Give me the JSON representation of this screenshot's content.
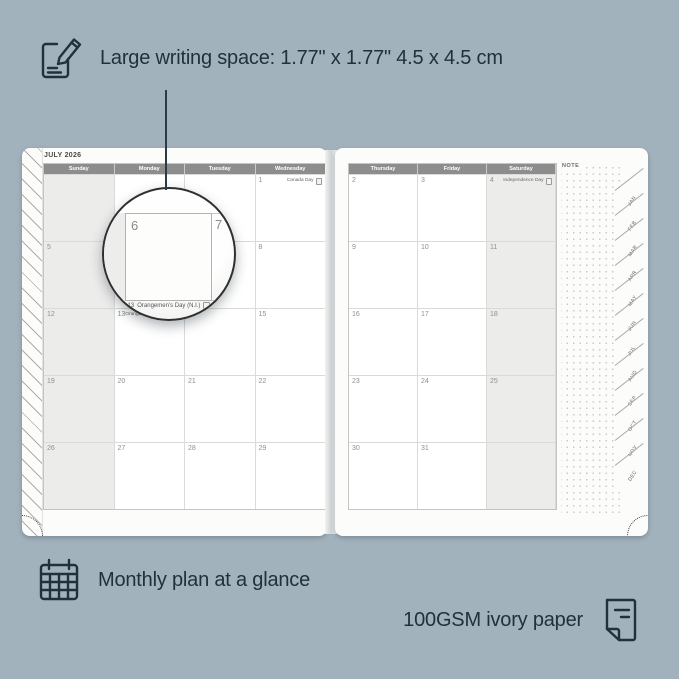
{
  "annotations": {
    "top": {
      "icon": "pencil-note-icon",
      "text": "Large writing space: 1.77\" x 1.77\" 4.5 x 4.5 cm"
    },
    "bottom_left": {
      "icon": "calendar-grid-icon",
      "text": "Monthly plan at a glance"
    },
    "bottom_right": {
      "icon": "paper-icon",
      "text": "100GSM ivory paper"
    }
  },
  "planner": {
    "title": "JULY 2026",
    "note_label": "NOTE",
    "left_page": {
      "day_headers": [
        "Sunday",
        "Monday",
        "Tuesday",
        "Wednesday"
      ],
      "weeks": [
        [
          {
            "day": ""
          },
          {
            "day": ""
          },
          {
            "day": ""
          },
          {
            "day": "1",
            "event": "Canada Day"
          }
        ],
        [
          {
            "day": "5"
          },
          {
            "day": "6"
          },
          {
            "day": "7"
          },
          {
            "day": "8"
          }
        ],
        [
          {
            "day": "12"
          },
          {
            "day": "13",
            "event": "Orangemen's Day (N.I.)"
          },
          {
            "day": "14"
          },
          {
            "day": "15"
          }
        ],
        [
          {
            "day": "19"
          },
          {
            "day": "20"
          },
          {
            "day": "21"
          },
          {
            "day": "22"
          }
        ],
        [
          {
            "day": "26"
          },
          {
            "day": "27"
          },
          {
            "day": "28"
          },
          {
            "day": "29"
          }
        ]
      ]
    },
    "right_page": {
      "day_headers": [
        "Thursday",
        "Friday",
        "Saturday"
      ],
      "weeks": [
        [
          {
            "day": "2"
          },
          {
            "day": "3"
          },
          {
            "day": "4",
            "event": "Independence Day"
          }
        ],
        [
          {
            "day": "9"
          },
          {
            "day": "10"
          },
          {
            "day": "11"
          }
        ],
        [
          {
            "day": "16"
          },
          {
            "day": "17"
          },
          {
            "day": "18"
          }
        ],
        [
          {
            "day": "23"
          },
          {
            "day": "24"
          },
          {
            "day": "25"
          }
        ],
        [
          {
            "day": "30"
          },
          {
            "day": "31"
          },
          {
            "day": ""
          }
        ]
      ]
    },
    "magnifier": {
      "day": "6",
      "next_day": "7",
      "below_day": "13",
      "event_below": "Orangemen's Day (N.I.)"
    },
    "month_tabs": [
      "JAN",
      "FEB",
      "MAR",
      "APR",
      "MAY",
      "JUN",
      "JUL",
      "AUG",
      "SEP",
      "OCT",
      "NOV",
      "DEC"
    ]
  },
  "colors": {
    "background": "#a2b2bc",
    "ink": "#22303a",
    "page": "#fcfcfb",
    "header_bar": "#8d8d8d",
    "shaded_column": "#ececeb",
    "magnifier_border": "#2f2f2f"
  }
}
